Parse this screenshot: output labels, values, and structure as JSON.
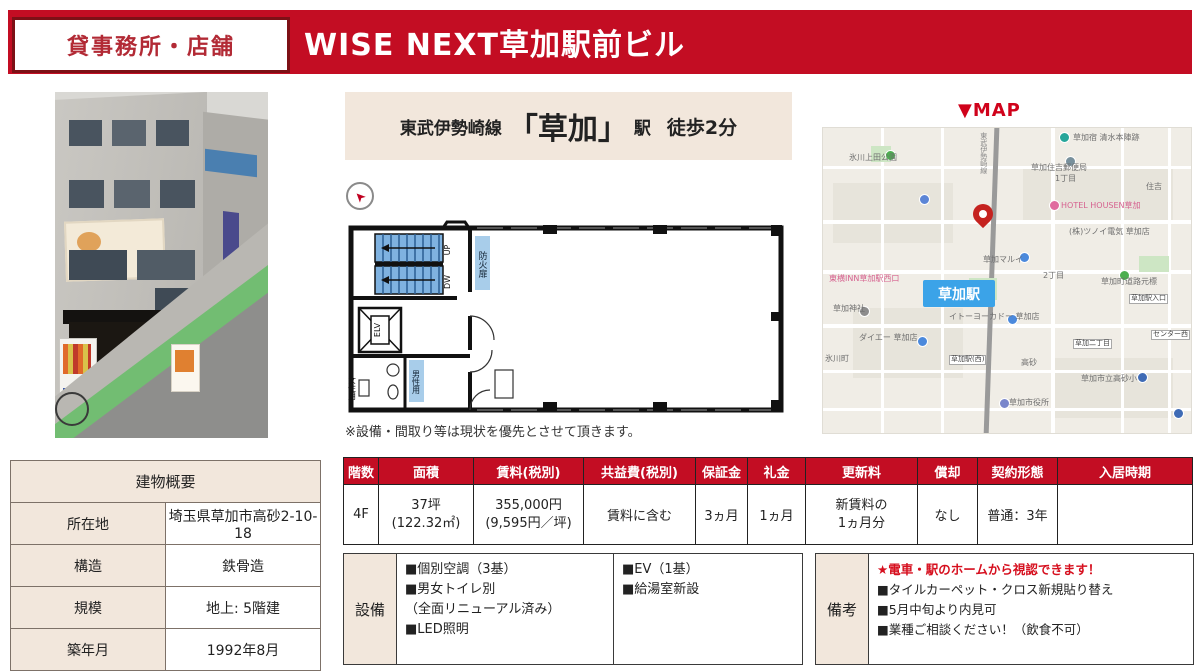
{
  "header": {
    "category": "貸事務所・店舗",
    "title": "WISE NEXT草加駅前ビル"
  },
  "access": {
    "line": "東武伊勢崎線",
    "station": "「草加」",
    "suffix": "駅",
    "walk": "徒歩2分"
  },
  "floorplan": {
    "up": "UP",
    "dw": "DW",
    "elv": "ELV",
    "fire_door": "防火扉",
    "mens": "男性用",
    "womens": "女性用",
    "note": "※設備・間取り等は現状を優先とさせて頂きます。"
  },
  "map": {
    "title": "▼MAP",
    "station_badge": "草加駅",
    "labels": [
      {
        "text": "氷川上田公園"
      },
      {
        "text": "草加宿 清水本陣跡"
      },
      {
        "text": "草加住吉郵便局"
      },
      {
        "text": "1丁目"
      },
      {
        "text": "住吉"
      },
      {
        "text": "HOTEL HOUSEN草加"
      },
      {
        "text": "(株)ツノイ電気 草加店"
      },
      {
        "text": "草加マルイ"
      },
      {
        "text": "2丁目"
      },
      {
        "text": "草加町道路元標"
      },
      {
        "text": "東横INN草加駅西口"
      },
      {
        "text": "草加駅入口"
      },
      {
        "text": "イトーヨーカドー 草加店"
      },
      {
        "text": "草加神社"
      },
      {
        "text": "ダイエー 草加店"
      },
      {
        "text": "氷川町"
      },
      {
        "text": "草加二丁目"
      },
      {
        "text": "センター西"
      },
      {
        "text": "高砂"
      },
      {
        "text": "草加駅(西)"
      },
      {
        "text": "草加市立高砂小"
      },
      {
        "text": "草加市役所"
      },
      {
        "text": "東武伊勢崎線"
      }
    ]
  },
  "building": {
    "title": "建物概要",
    "rows": [
      {
        "label": "所在地",
        "value": "埼玉県草加市高砂2-10-18"
      },
      {
        "label": "構造",
        "value": "鉄骨造"
      },
      {
        "label": "規模",
        "value": "地上: 5階建"
      },
      {
        "label": "築年月",
        "value": "1992年8月"
      }
    ]
  },
  "unit": {
    "headers": [
      "階数",
      "面積",
      "賃料(税別)",
      "共益費(税別)",
      "保証金",
      "礼金",
      "更新料",
      "償却",
      "契約形態",
      "入居時期"
    ],
    "row": {
      "floor": "4F",
      "area": "37坪\n(122.32㎡)",
      "rent": "355,000円\n(9,595円／坪)",
      "common_fee": "賃料に含む",
      "deposit": "3ヵ月",
      "key_money": "1ヵ月",
      "renewal": "新賃料の\n1ヵ月分",
      "amortization": "なし",
      "contract": "普通：3年",
      "move_in": ""
    }
  },
  "facilities": {
    "label": "設備",
    "col1": [
      "■個別空調（3基）",
      "■男女トイレ別",
      "（全面リニューアル済み）",
      "■LED照明"
    ],
    "col2": [
      "■EV（1基）",
      "■給湯室新設"
    ]
  },
  "remarks": {
    "label": "備考",
    "highlight": "★電車・駅のホームから視認できます！",
    "items": [
      "■タイルカーペット・クロス新規貼り替え",
      "■5月中旬より内見可",
      "■業種ご相談ください！（飲食不可）"
    ]
  },
  "colors": {
    "accent_red": "#c30d23",
    "dark_red_border": "#7d1016",
    "beige": "#f2e7dc",
    "map_station_blue": "#3ba3e8",
    "map_pink": "#d6618f",
    "highlight_red": "#d60f1e"
  }
}
